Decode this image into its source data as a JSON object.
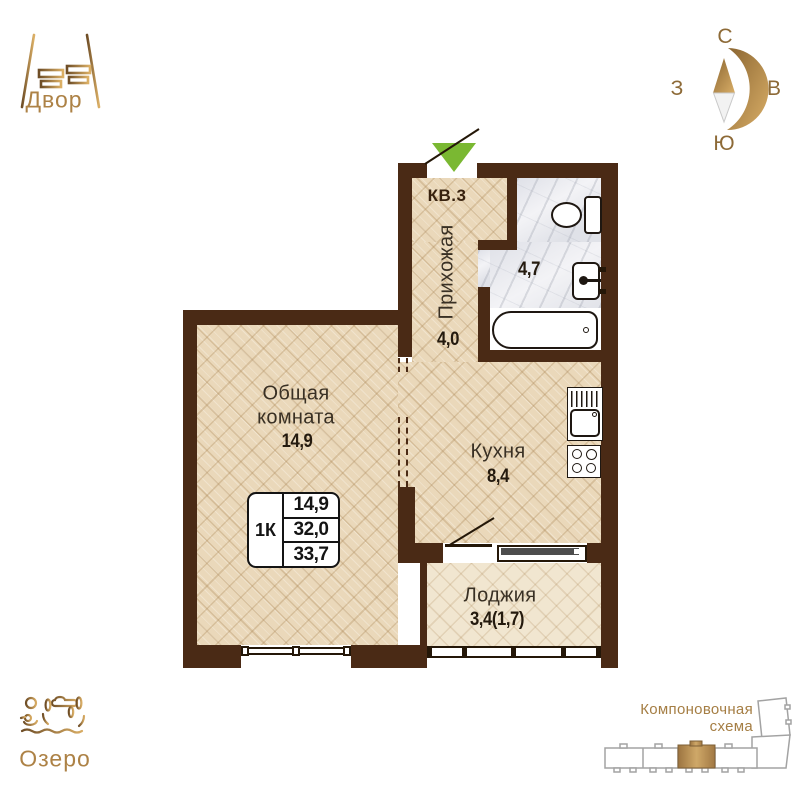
{
  "yard": {
    "label": "Двор"
  },
  "lake": {
    "label": "Озеро"
  },
  "compass": {
    "north": "С",
    "east": "В",
    "south": "Ю",
    "west": "З"
  },
  "plan": {
    "apartment_label": "КВ.3",
    "hallway_name": "Прихожая",
    "hallway_area": "4,0",
    "bathroom_area": "4,7",
    "kitchen_name": "Кухня",
    "kitchen_area": "8,4",
    "living_name": "Общая комната",
    "living_area": "14,9",
    "loggia_name": "Лоджия",
    "loggia_area": "3,4(1,7)"
  },
  "info_box": {
    "type": "1К",
    "living": "14,9",
    "area": "32,0",
    "total": "33,7"
  },
  "scheme": {
    "title": "Компоновочная схема"
  },
  "colors": {
    "wall": "#4a2a15",
    "gold": "#ad8246",
    "entrance_green": "#7ab832"
  }
}
